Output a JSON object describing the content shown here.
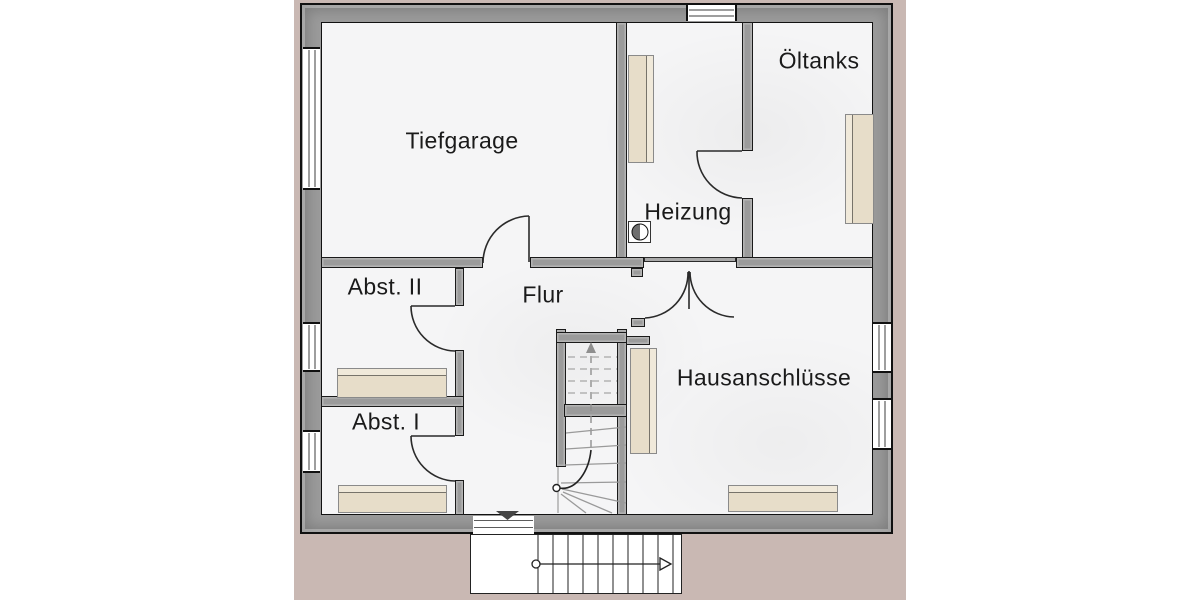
{
  "plan": {
    "rooms": {
      "tiefgarage": "Tiefgarage",
      "heizung": "Heizung",
      "oeltanks": "Öltanks",
      "abst2": "Abst. II",
      "abst1": "Abst. I",
      "flur": "Flur",
      "hausanschluesse": "Hausanschlüsse"
    },
    "colors": {
      "apron": "#c9b8b3",
      "wall": "#9b9b9b",
      "floor": "#f5f5f6",
      "furniture": "#e7ddc9",
      "outline": "#111111"
    },
    "icons": {
      "stair_direction": "up-arrow",
      "entrance_marker": "down-triangle",
      "boiler": "half-filled-circle",
      "exterior_stair_arrow": "right-arrow"
    }
  }
}
